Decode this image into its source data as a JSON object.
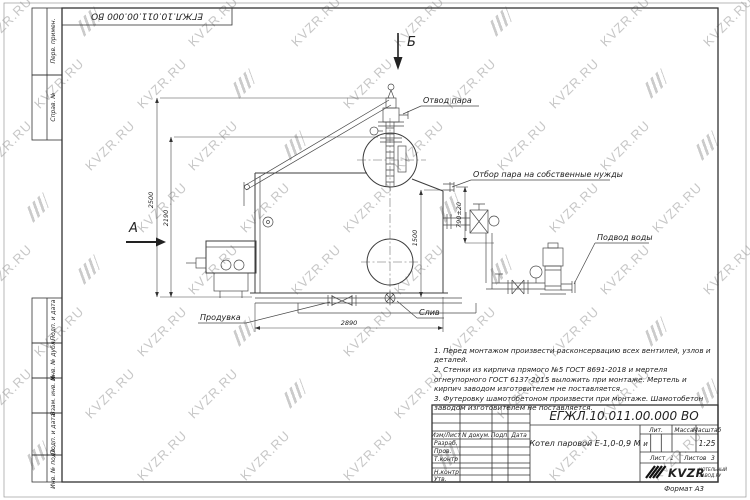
{
  "watermark": {
    "text": "KVZR.RU"
  },
  "frame": {
    "doc_number_top": "ЕГЖЛ.10.011.00.000  ВО",
    "format_label": "Формат А3",
    "margin_labels": [
      "Перв. примен.",
      "Справ. №",
      "Подп. и дата",
      "Инв. № дубл.",
      "Взам. инв. №",
      "Подп. и дата",
      "Инв. № подл."
    ]
  },
  "drawing": {
    "view_a": "А",
    "view_b": "Б",
    "labels": {
      "steam_outlet": "Отвод пара",
      "steam_takeoff": "Отбор пара на собственные нужды",
      "water_inlet": "Подвод воды",
      "blowdown": "Продувка",
      "drain": "Слив"
    },
    "dimensions": {
      "height_overall": "2500",
      "height_body": "2190",
      "height_steam": "1500",
      "height_takeoff": "790±20",
      "length_body": "2890"
    }
  },
  "notes": [
    "1. Перед монтажом произвести расконсервацию всех вентилей, узлов и деталей.",
    "2. Стенки из кирпича прямого №5 ГОСТ 8691-2018 и мертеля огнеупорного ГОСТ 6137-2015 выложить при монтаже. Мертель и кирпич заводом изготовителем не поставляется.",
    "3. Футеровку шамотобетоном произвести при монтаже. Шамотобетон заводом изготовителем не поставляется."
  ],
  "title_block": {
    "doc_number": "ЕГЖЛ.10.011.00.000  ВО",
    "product_name": "Котел паровой Е-1,0-0,9 М",
    "headers": {
      "izm_list": "Изм/Лист",
      "n_dokum": "N докум.",
      "podp": "Подп.",
      "data": "Дата",
      "lit": "Лит.",
      "massa": "Масса",
      "masshtab": "Масштаб"
    },
    "rows": {
      "razrab": "Разраб.",
      "prov": "Пров.",
      "t_kontr": "Т.контр",
      "n_kontr": "Н.контр",
      "utv": "Утв."
    },
    "lit_value": "и",
    "masshtab_value": "1:25",
    "sheet_info": {
      "list_label": "Лист",
      "list_value": "1",
      "listov_label": "Листов",
      "listov_value": "3"
    },
    "company": {
      "name": "KVZR",
      "tagline_line1": "КОТЕЛЬНЫЙ",
      "tagline_line2": "ЗАВОД.РУ"
    }
  }
}
